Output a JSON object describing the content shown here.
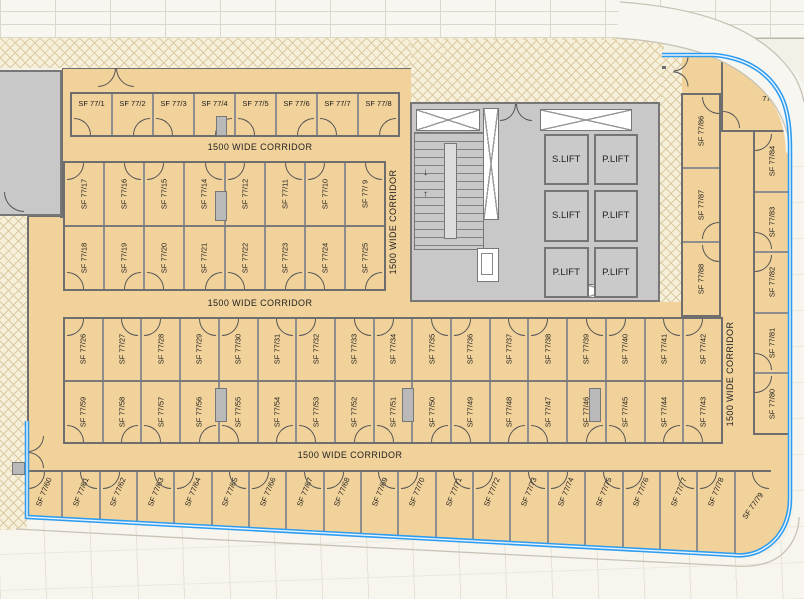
{
  "plan": {
    "corridor_label": "1500 WIDE CORRIDOR",
    "rooms": {
      "block_a": [
        "SF 77/1",
        "SF 77/2",
        "SF 77/3",
        "SF 77/4",
        "SF 77/5",
        "SF 77/6",
        "SF 77/7",
        "SF 77/8"
      ],
      "block_b_upper": [
        "SF 77/17",
        "SF 77/16",
        "SF 77/15",
        "SF 77/14",
        "SF 77/12",
        "SF 77/11",
        "SF 77/10",
        "SF 77/ 9"
      ],
      "block_b_lower": [
        "SF 77/18",
        "SF 77/19",
        "SF 77/20",
        "SF 77/21",
        "SF 77/22",
        "SF 77/23",
        "SF 77/24",
        "SF 77/25"
      ],
      "block_c_upper": [
        "SF 77/26",
        "SF 77/27",
        "SF 77/28",
        "SF 77/29",
        "SF 77/30",
        "SF 77/31",
        "SF 77/32",
        "SF 77/33",
        "SF 77/34",
        "SF 77/35",
        "SF 77/36",
        "SF 77/37",
        "SF 77/38",
        "SF 77/39",
        "SF 77/40",
        "SF 77/41",
        "SF 77/42"
      ],
      "block_c_lower": [
        "SF 77/59",
        "SF 77/58",
        "SF 77/57",
        "SF 77/56",
        "SF 77/55",
        "SF 77/54",
        "SF 77/53",
        "SF 77/52",
        "SF 77/51",
        "SF 77/50",
        "SF 77/49",
        "SF 77/48",
        "SF 77/47",
        "SF 77/46",
        "SF 77/45",
        "SF 77/44",
        "SF 77/43"
      ],
      "bottom_row": [
        "SF 77/60",
        "SF 77/61",
        "SF 77/62",
        "SF 77/63",
        "SF 77/64",
        "SF 77/65",
        "SF 77/66",
        "SF 77/67",
        "SF 77/68",
        "SF 77/69",
        "SF 77/70",
        "SF 77/71",
        "SF 77/72",
        "SF 77/73",
        "SF 77/74",
        "SF 77/75",
        "SF 77/76",
        "SF 77/77",
        "SF 77/78",
        "SF 77/79"
      ],
      "wing_inner": [
        "SF 77/86",
        "SF 77/87",
        "SF 77/88"
      ],
      "wing_outer": [
        "SF 77/84",
        "SF 77/83",
        "SF 77/82",
        "SF 77/81",
        "SF 77/80"
      ],
      "corner_room_line1": "SF",
      "corner_room_line2": "77/85"
    },
    "core": {
      "lifts": [
        "S.LIFT",
        "P.LIFT",
        "S.LIFT",
        "P.LIFT",
        "P.LIFT",
        "P.LIFT"
      ],
      "stair_down_arrow": "↓",
      "stair_up_arrow": "↑"
    },
    "colors": {
      "floor": "#F2D29B",
      "hatch_bg": "#F6EFD9",
      "hatch_line": "#DCCBA2",
      "core_gray": "#C8C8C8",
      "wall": "#6E6E6E",
      "blue": "#2D9CF0",
      "paving": "#F7F5EE",
      "band": "#F8F6F1"
    }
  }
}
